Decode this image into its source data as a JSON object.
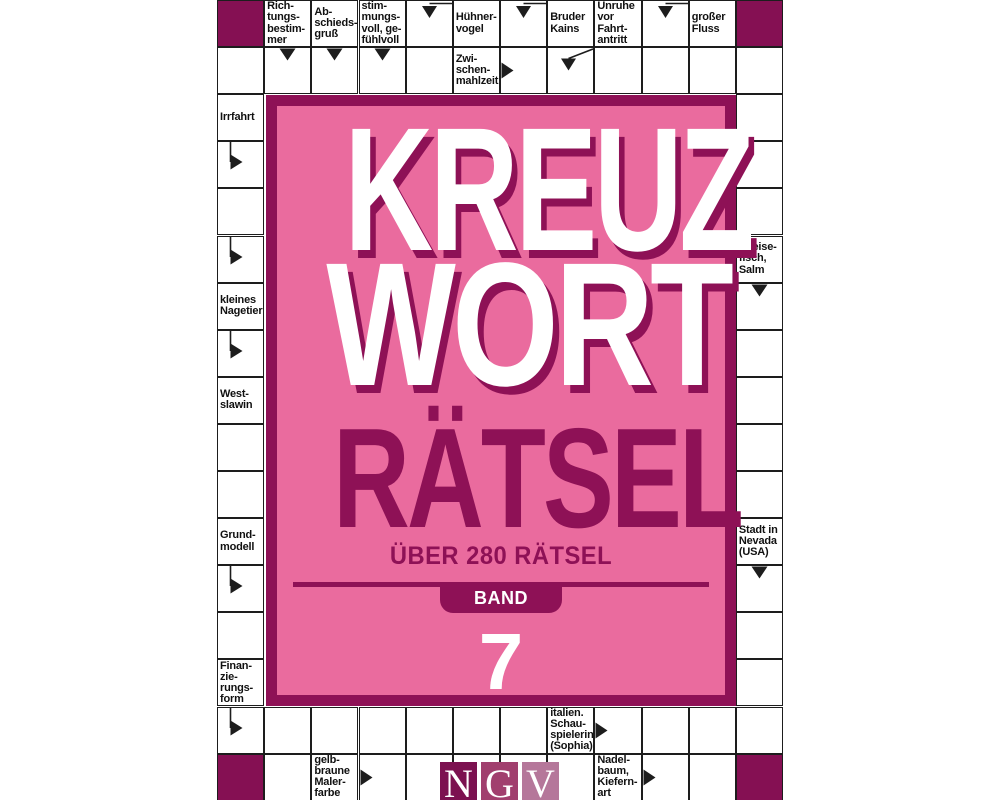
{
  "cover": {
    "title_line1": "KREUZ",
    "title_line2": "WORT",
    "title_line3": "RÄTSEL",
    "subtitle": "ÜBER 280 RÄTSEL",
    "band_label": "BAND",
    "band_number": "7",
    "publisher": [
      "N",
      "G",
      "V"
    ]
  },
  "colors": {
    "panel_pink": "#ea6b9e",
    "magenta": "#8e1156",
    "blocked_cell": "#851053",
    "grid_line": "#1d1d1d",
    "ngv_n": "#7c1150",
    "ngv_g": "#a13f6e",
    "ngv_v": "#b5779a"
  },
  "grid": {
    "clues": [
      {
        "id": "richtungsbestimmer",
        "col": 1,
        "row": 0,
        "text": "Rich-\ntungs-\nbestim-\nmer"
      },
      {
        "id": "abschiedsgruss",
        "col": 2,
        "row": 0,
        "text": "Ab-\nschieds-\ngruß"
      },
      {
        "id": "stimmungsvoll",
        "col": 3,
        "row": 0,
        "text": "stim-\nmungs-\nvoll, ge-\nfühlvoll"
      },
      {
        "id": "huehnervogel",
        "col": 5,
        "row": 0,
        "text": "Hühner-\nvogel"
      },
      {
        "id": "bruder-kains",
        "col": 7,
        "row": 0,
        "text": "Bruder\nKains"
      },
      {
        "id": "unruhe-vor-fahrtantritt",
        "col": 8,
        "row": 0,
        "text": "Unruhe\nvor\nFahrt-\nantritt"
      },
      {
        "id": "grosser-fluss",
        "col": 10,
        "row": 0,
        "text": "großer\nFluss"
      },
      {
        "id": "zwischenmahlzeit",
        "col": 5,
        "row": 1,
        "text": "Zwi-\nschen-\nmahlzeit"
      },
      {
        "id": "irrfahrt",
        "col": 0,
        "row": 2,
        "text": "Irrfahrt"
      },
      {
        "id": "kleines-nagetier",
        "col": 0,
        "row": 6,
        "text": "kleines\nNagetier"
      },
      {
        "id": "westslawin",
        "col": 0,
        "row": 8,
        "text": "West-\nslawin"
      },
      {
        "id": "grundmodell",
        "col": 0,
        "row": 11,
        "text": "Grund-\nmodell"
      },
      {
        "id": "finanzierungsform",
        "col": 0,
        "row": 14,
        "text": "Finan-\nzie-\nrungs-\nform"
      },
      {
        "id": "speisefisch-salm",
        "col": 11,
        "row": 5,
        "text": "Speise-\nfisch,\nSalm"
      },
      {
        "id": "stadt-in-nevada",
        "col": 11,
        "row": 11,
        "text": "Stadt in\nNevada\n(USA)"
      },
      {
        "id": "italien-schauspielerin",
        "col": 7,
        "row": 15,
        "text": "italien.\nSchau-\nspielerin\n(Sophia)"
      },
      {
        "id": "gelbbraune-malerfarbe",
        "col": 2,
        "row": 16,
        "text": "gelb-\nbraune\nMaler-\nfarbe"
      },
      {
        "id": "nadelbaum",
        "col": 8,
        "row": 16,
        "text": "Nadel-\nbaum,\nKiefern-\nart"
      }
    ],
    "arrows": [
      {
        "col": 1,
        "row": 1,
        "type": "down"
      },
      {
        "col": 2,
        "row": 1,
        "type": "down"
      },
      {
        "col": 3,
        "row": 1,
        "type": "down"
      },
      {
        "col": 4,
        "row": 0,
        "type": "bent-down"
      },
      {
        "col": 6,
        "row": 0,
        "type": "bent-down"
      },
      {
        "col": 9,
        "row": 0,
        "type": "bent-down"
      },
      {
        "col": 7,
        "row": 1,
        "type": "diag-down"
      },
      {
        "col": 6,
        "row": 1,
        "type": "right"
      },
      {
        "col": 0,
        "row": 3,
        "type": "bent-right"
      },
      {
        "col": 0,
        "row": 5,
        "type": "bent-right"
      },
      {
        "col": 0,
        "row": 7,
        "type": "bent-right"
      },
      {
        "col": 0,
        "row": 12,
        "type": "bent-right"
      },
      {
        "col": 0,
        "row": 15,
        "type": "bent-right"
      },
      {
        "col": 11,
        "row": 6,
        "type": "down"
      },
      {
        "col": 11,
        "row": 12,
        "type": "down"
      },
      {
        "col": 8,
        "row": 15,
        "type": "right"
      },
      {
        "col": 3,
        "row": 16,
        "type": "right"
      },
      {
        "col": 9,
        "row": 16,
        "type": "right"
      }
    ],
    "dark_cells": [
      [
        0,
        0
      ],
      [
        11,
        0
      ],
      [
        0,
        16
      ],
      [
        11,
        16
      ]
    ]
  }
}
